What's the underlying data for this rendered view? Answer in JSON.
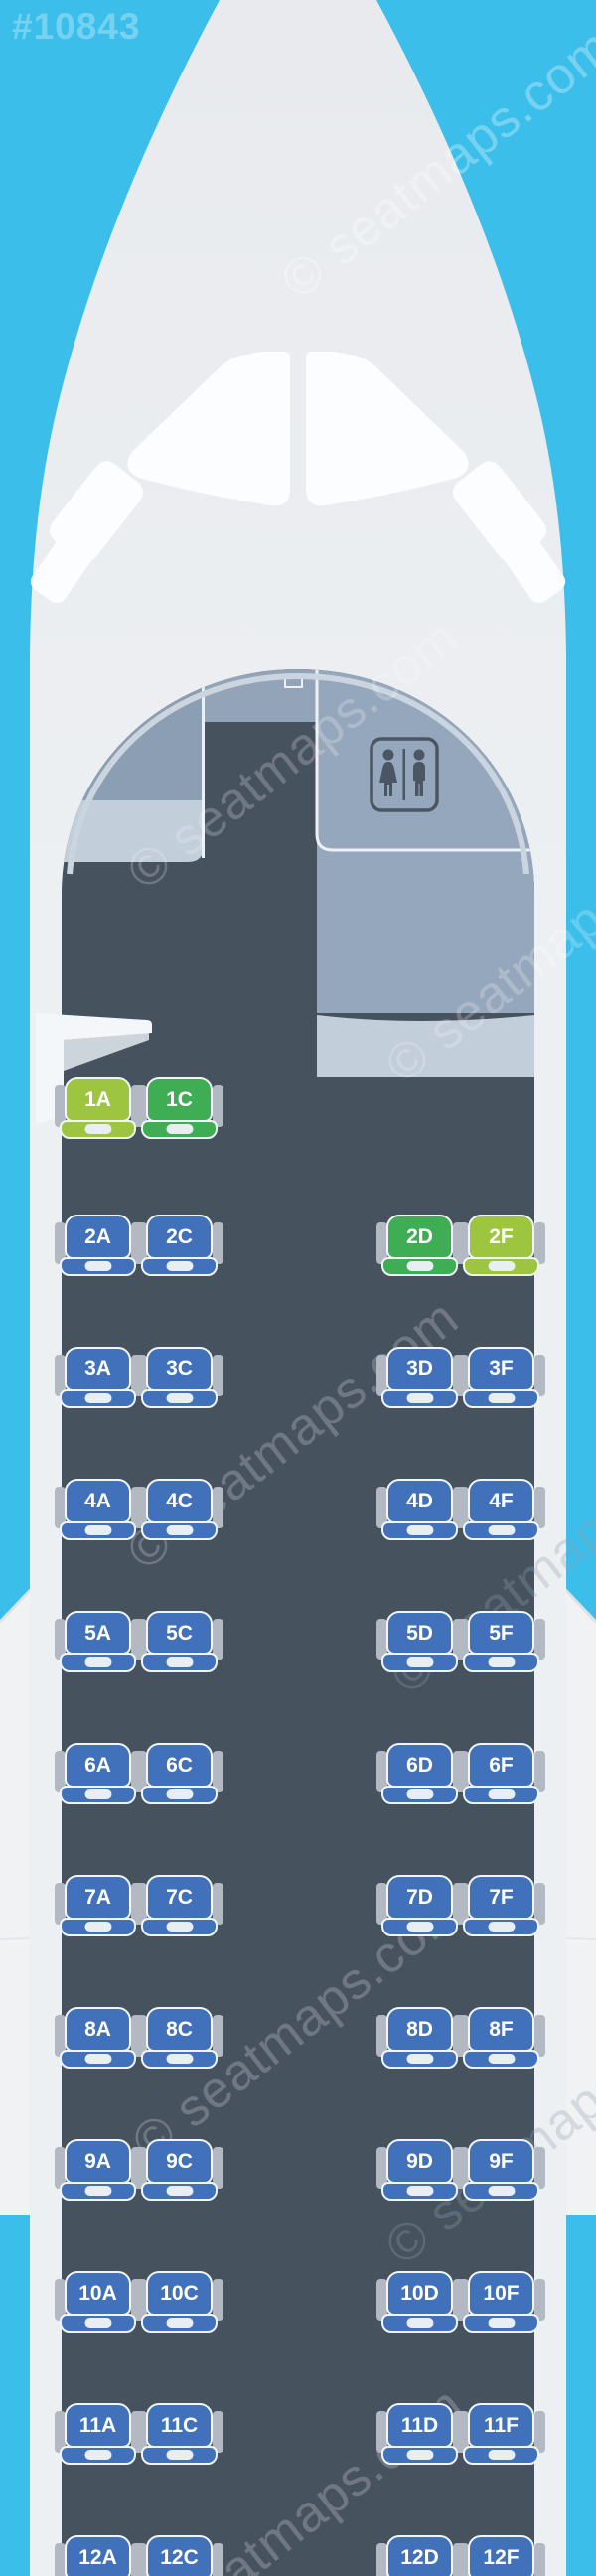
{
  "plane_id": "#10843",
  "watermark": {
    "text": "© seatmaps.com"
  },
  "icons": {
    "lavatory": "wc-restroom-icon"
  },
  "colors": {
    "background": "#3bbfea",
    "fuselage": "#edf0f3",
    "nose_cone": "#e8eaee",
    "cockpit_windows": "#fcfdff",
    "cabin_floor": "#47525f",
    "entry_panels": "#8c9eb3",
    "lavatory_panel": "#95a7bc",
    "counter_band": "#c2ceda",
    "wing": "#f0f2f4",
    "seat_standard_blue": "#4271bc",
    "seat_green": "#3ead53",
    "seat_lime": "#9ec53f",
    "seat_border": "#f2f5f7",
    "armrest": "#b2b9c2"
  },
  "cabin": {
    "layout": "2-2 (A C | D F)",
    "rows": [
      {
        "label": "1",
        "seats": [
          {
            "id": "1A",
            "color": "lime"
          },
          {
            "id": "1C",
            "color": "green"
          }
        ]
      },
      {
        "label": "2",
        "seats": [
          {
            "id": "2A",
            "color": "blue"
          },
          {
            "id": "2C",
            "color": "blue"
          },
          {
            "id": "2D",
            "color": "green"
          },
          {
            "id": "2F",
            "color": "lime"
          }
        ]
      },
      {
        "label": "3",
        "seats": [
          {
            "id": "3A",
            "color": "blue"
          },
          {
            "id": "3C",
            "color": "blue"
          },
          {
            "id": "3D",
            "color": "blue"
          },
          {
            "id": "3F",
            "color": "blue"
          }
        ]
      },
      {
        "label": "4",
        "seats": [
          {
            "id": "4A",
            "color": "blue"
          },
          {
            "id": "4C",
            "color": "blue"
          },
          {
            "id": "4D",
            "color": "blue"
          },
          {
            "id": "4F",
            "color": "blue"
          }
        ]
      },
      {
        "label": "5",
        "seats": [
          {
            "id": "5A",
            "color": "blue"
          },
          {
            "id": "5C",
            "color": "blue"
          },
          {
            "id": "5D",
            "color": "blue"
          },
          {
            "id": "5F",
            "color": "blue"
          }
        ]
      },
      {
        "label": "6",
        "seats": [
          {
            "id": "6A",
            "color": "blue"
          },
          {
            "id": "6C",
            "color": "blue"
          },
          {
            "id": "6D",
            "color": "blue"
          },
          {
            "id": "6F",
            "color": "blue"
          }
        ]
      },
      {
        "label": "7",
        "seats": [
          {
            "id": "7A",
            "color": "blue"
          },
          {
            "id": "7C",
            "color": "blue"
          },
          {
            "id": "7D",
            "color": "blue"
          },
          {
            "id": "7F",
            "color": "blue"
          }
        ]
      },
      {
        "label": "8",
        "seats": [
          {
            "id": "8A",
            "color": "blue"
          },
          {
            "id": "8C",
            "color": "blue"
          },
          {
            "id": "8D",
            "color": "blue"
          },
          {
            "id": "8F",
            "color": "blue"
          }
        ]
      },
      {
        "label": "9",
        "seats": [
          {
            "id": "9A",
            "color": "blue"
          },
          {
            "id": "9C",
            "color": "blue"
          },
          {
            "id": "9D",
            "color": "blue"
          },
          {
            "id": "9F",
            "color": "blue"
          }
        ]
      },
      {
        "label": "10",
        "seats": [
          {
            "id": "10A",
            "color": "blue"
          },
          {
            "id": "10C",
            "color": "blue"
          },
          {
            "id": "10D",
            "color": "blue"
          },
          {
            "id": "10F",
            "color": "blue"
          }
        ]
      },
      {
        "label": "11",
        "seats": [
          {
            "id": "11A",
            "color": "blue"
          },
          {
            "id": "11C",
            "color": "blue"
          },
          {
            "id": "11D",
            "color": "blue"
          },
          {
            "id": "11F",
            "color": "blue"
          }
        ]
      },
      {
        "label": "12",
        "seats": [
          {
            "id": "12A",
            "color": "blue"
          },
          {
            "id": "12C",
            "color": "blue"
          },
          {
            "id": "12D",
            "color": "blue"
          },
          {
            "id": "12F",
            "color": "blue"
          }
        ]
      }
    ]
  }
}
